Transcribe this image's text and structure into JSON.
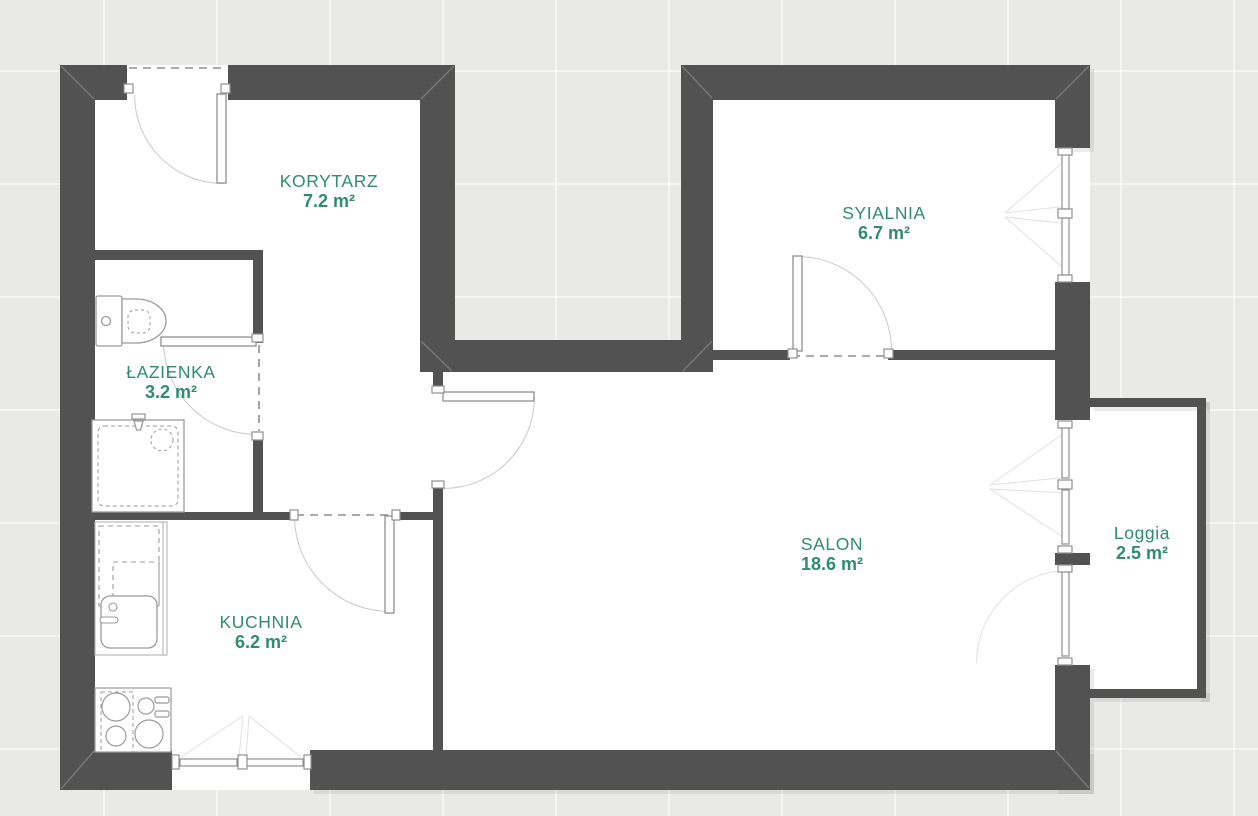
{
  "plan": {
    "type": "apartment-floor-plan",
    "rooms": [
      {
        "id": "korytarz",
        "name": "KORYTARZ",
        "area": "7.2 m²"
      },
      {
        "id": "sypialnia",
        "name": "SYIALNIA",
        "area": "6.7 m²"
      },
      {
        "id": "lazienka",
        "name": "ŁAZIENKA",
        "area": "3.2 m²"
      },
      {
        "id": "kuchnia",
        "name": "KUCHNIA",
        "area": "6.2 m²"
      },
      {
        "id": "salon",
        "name": "SALON",
        "area": "18.6 m²"
      },
      {
        "id": "loggia",
        "name": "Loggia",
        "area": "2.5 m²"
      }
    ],
    "colors": {
      "wall": "#525252",
      "label": "#2f8b71",
      "background": "#e9e9e8",
      "floor": "#ffffff"
    }
  }
}
